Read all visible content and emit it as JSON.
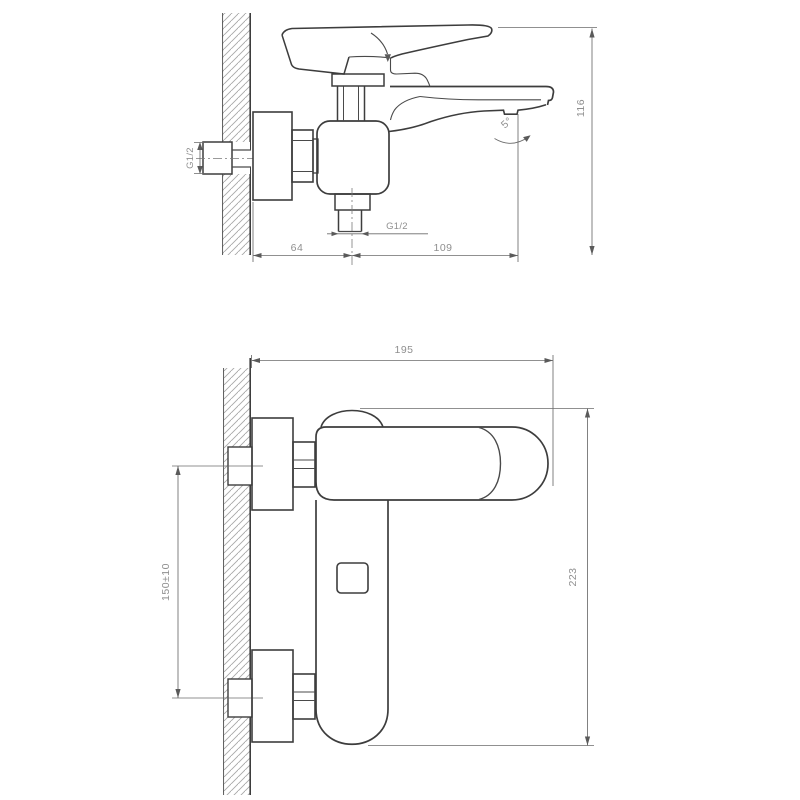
{
  "drawing": {
    "type": "technical-drawing",
    "subject": "Wall-mounted single-lever bath mixer faucet — dimensional drawing, two orthographic views",
    "colors": {
      "background": "#ffffff",
      "object_line": "#3d3d3d",
      "dimension_line": "#6b6b6b",
      "hatch_line": "#a8a8a8",
      "label_text": "#8f8f8f"
    },
    "side_view": {
      "title": "side view",
      "labels": {
        "inlet_thread": "G1/2",
        "outlet_thread": "G1/2",
        "spout_angle": "5°",
        "dim_wall_to_outlet_axis": "64",
        "dim_outlet_axis_to_aerator": "109",
        "dim_height": "116"
      }
    },
    "front_view": {
      "title": "front view",
      "labels": {
        "dim_overall_width": "195",
        "dim_overall_height": "223",
        "dim_inlet_spacing": "150±10"
      }
    }
  }
}
